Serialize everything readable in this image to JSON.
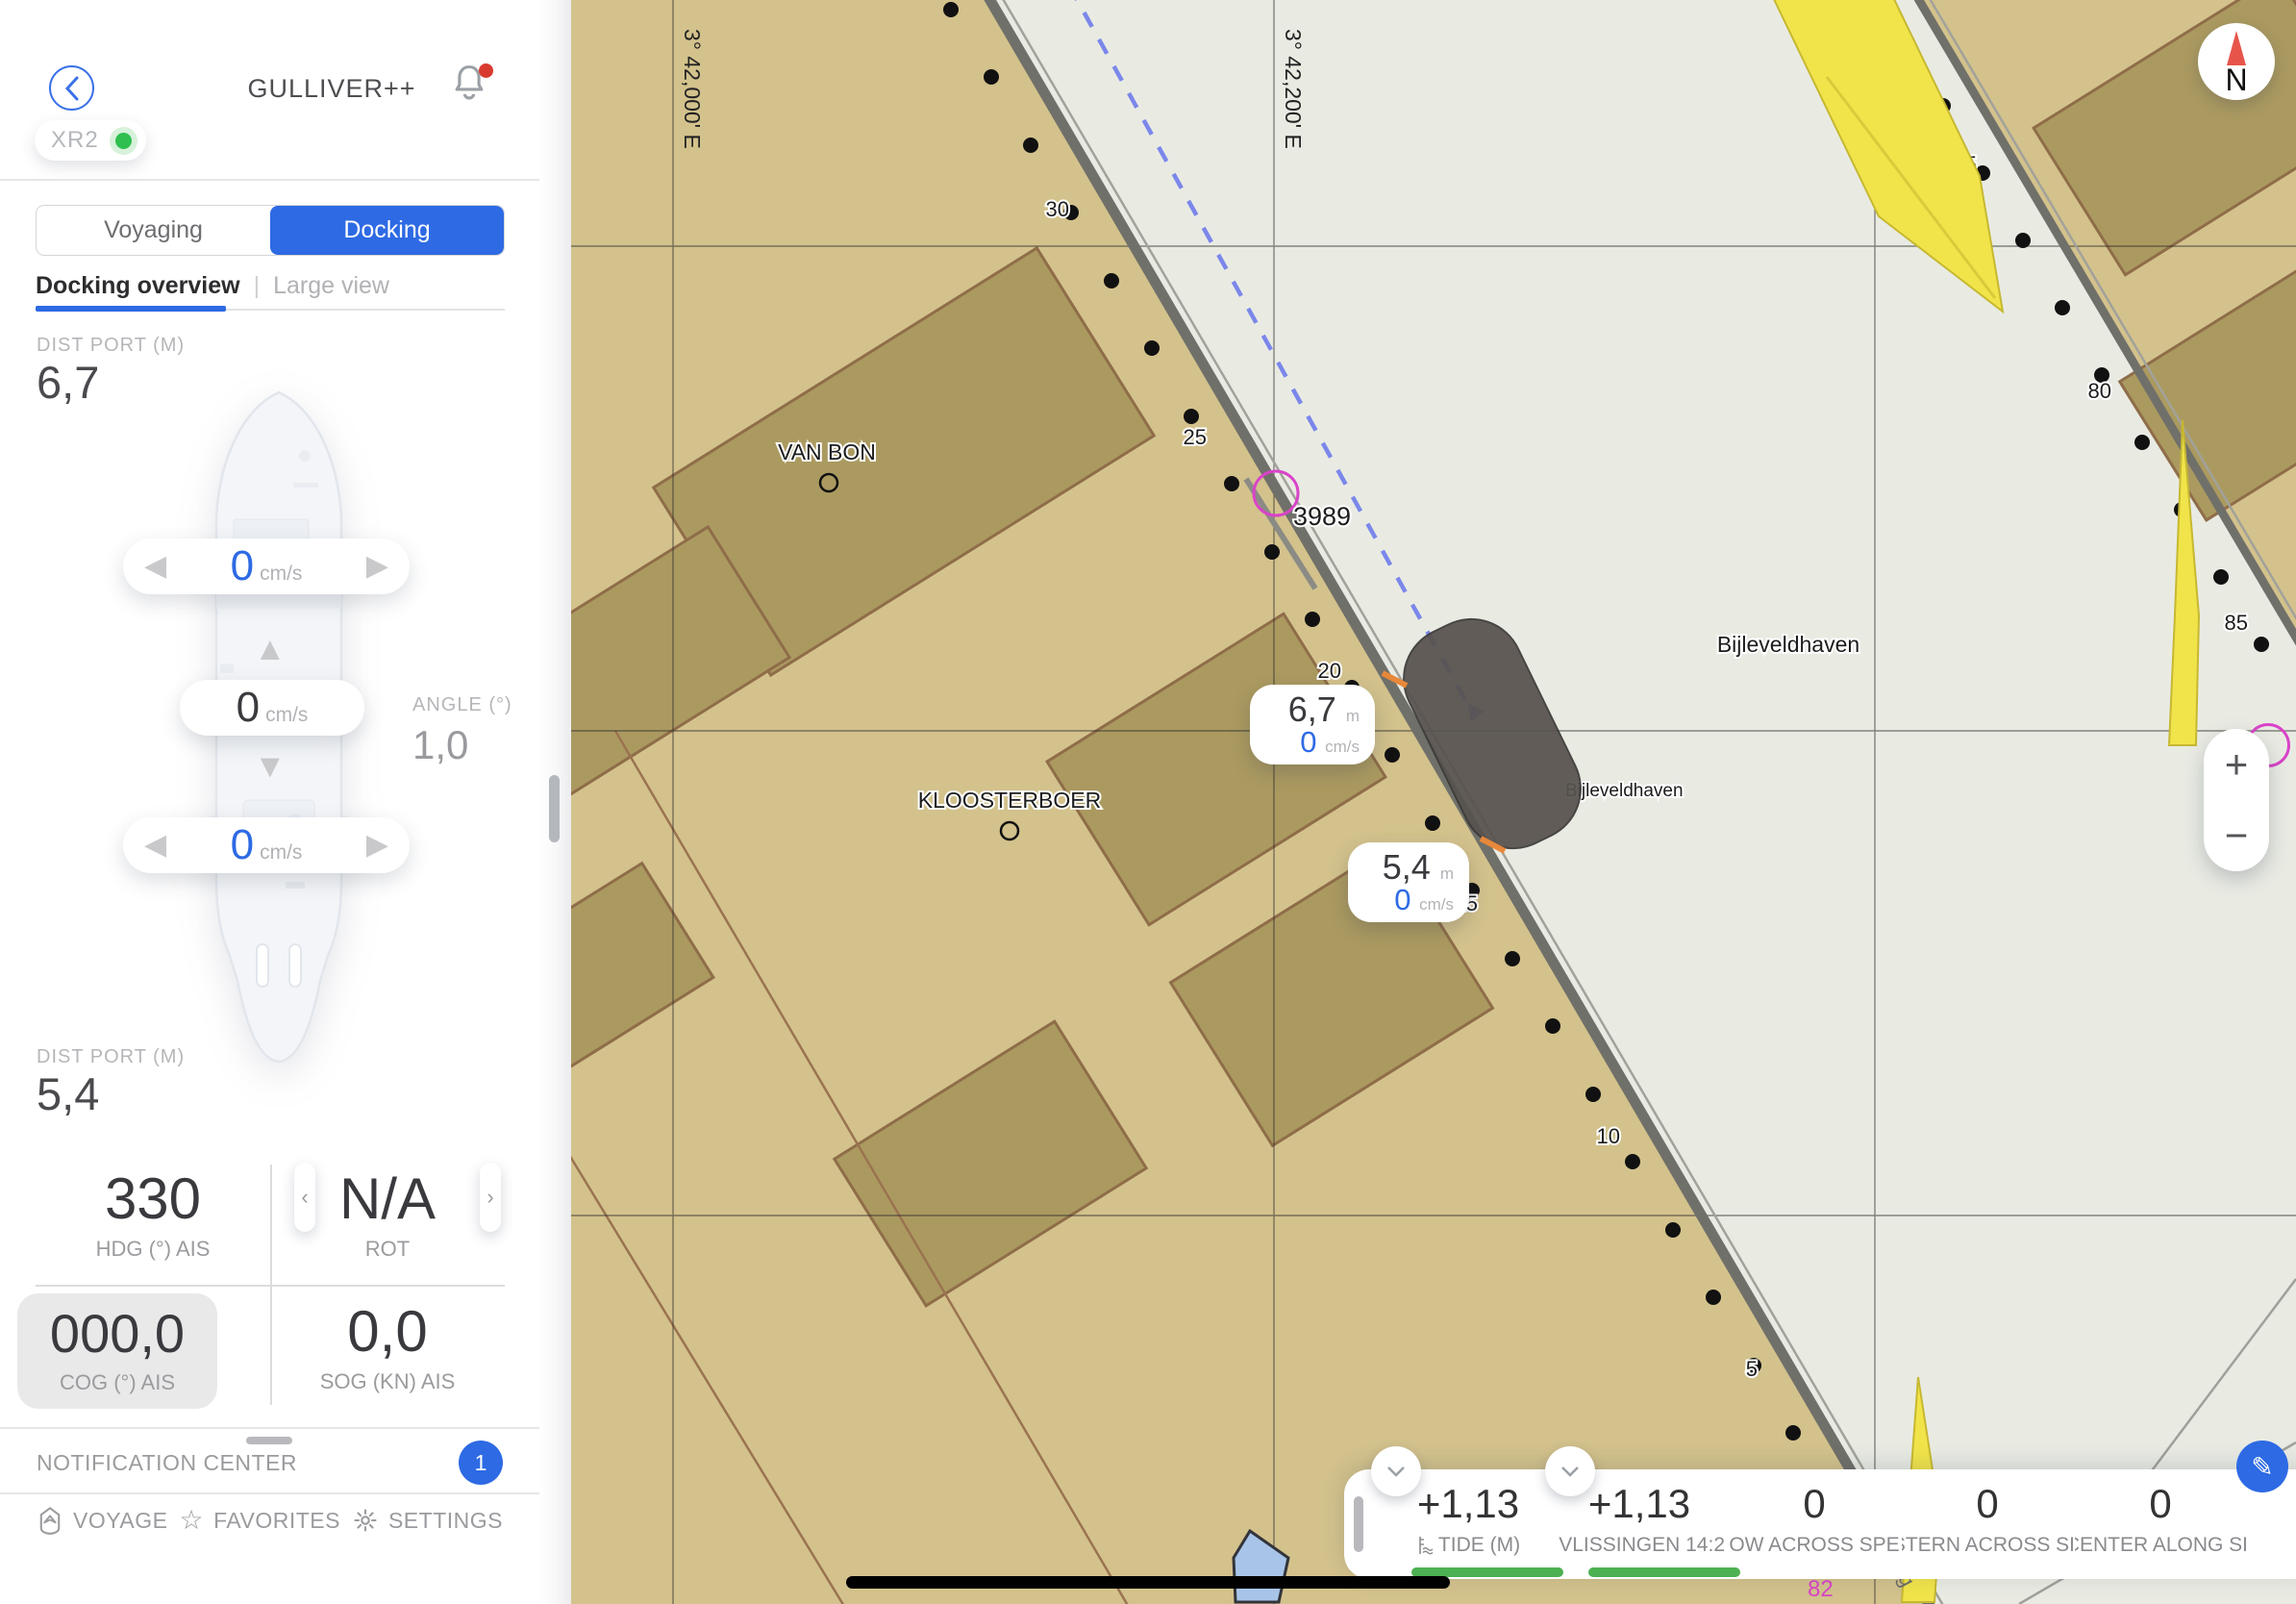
{
  "colors": {
    "accent_blue": "#2d6ae4",
    "land": "#d3c28c",
    "water": "#e9ebe3",
    "building": "#ab9a60",
    "building_outline": "#8f6d49",
    "quay_gray": "#70706a",
    "ship_marker_gray": "#57524e",
    "caution_yellow": "#f1e44a",
    "berth_magenta": "#d943c8",
    "tide_green": "#4db052",
    "alert_red": "#d93a2f",
    "compass_red": "#e8544a"
  },
  "header": {
    "title": "GULLIVER++",
    "status_pill": "XR2"
  },
  "tabs": {
    "voyaging": "Voyaging",
    "docking": "Docking",
    "overview": "Docking overview",
    "large_view": "Large view"
  },
  "docking": {
    "dist_port_top_label": "DIST PORT (M)",
    "dist_port_top_value": "6,7",
    "dist_port_bottom_label": "DIST PORT (M)",
    "dist_port_bottom_value": "5,4",
    "bow_speed": {
      "value": "0",
      "unit": "cm/s"
    },
    "lateral_speed": {
      "value": "0",
      "unit": "cm/s"
    },
    "stern_speed": {
      "value": "0",
      "unit": "cm/s"
    },
    "angle_label": "ANGLE (°)",
    "angle_value": "1,0"
  },
  "stats": {
    "hdg": {
      "value": "330",
      "label": "HDG (°) AIS"
    },
    "rot": {
      "value": "N/A",
      "label": "ROT"
    },
    "cog": {
      "value": "000,0",
      "label": "COG (°) AIS"
    },
    "sog": {
      "value": "0,0",
      "label": "SOG (KN) AIS"
    }
  },
  "notification_center": {
    "label": "NOTIFICATION CENTER",
    "badge": "1"
  },
  "bottom_nav": {
    "voyage": "VOYAGE",
    "favorites": "FAVORITES",
    "settings": "SETTINGS"
  },
  "map": {
    "grid_lon_left": "3° 42,000' E",
    "grid_lon_right": "3° 42,200' E",
    "label_van_bon": "VAN BON",
    "label_kloosterboer": "KLOOSTERBOER",
    "label_bijleveldhaven": "Bijleveldhaven",
    "label_bijleveldhaven_small": "Bijleveldhaven",
    "chart_number": "3989",
    "road_fragment": "eg",
    "misc_number": "82",
    "depths_left": [
      "30",
      "25",
      "20",
      "15",
      "10",
      "5"
    ],
    "depths_right": [
      "75",
      "80",
      "85"
    ],
    "compass_label": "N",
    "zoom_in": "+",
    "zoom_out": "−",
    "tooltip_bow": {
      "value": "6,7",
      "unit": "m",
      "speed": "0",
      "speed_unit": "cm/s"
    },
    "tooltip_stern": {
      "value": "5,4",
      "unit": "m",
      "speed": "0",
      "speed_unit": "cm/s"
    }
  },
  "bottom_bar": {
    "cells": [
      {
        "value": "+1,13",
        "label": "TIDE (M)"
      },
      {
        "value": "+1,13",
        "label": "VLISSINGEN 14:2"
      },
      {
        "value": "0",
        "label": "BOW ACROSS SPEE"
      },
      {
        "value": "0",
        "label": "STERN ACROSS SP"
      },
      {
        "value": "0",
        "label": "CENTER ALONG SP"
      }
    ]
  }
}
